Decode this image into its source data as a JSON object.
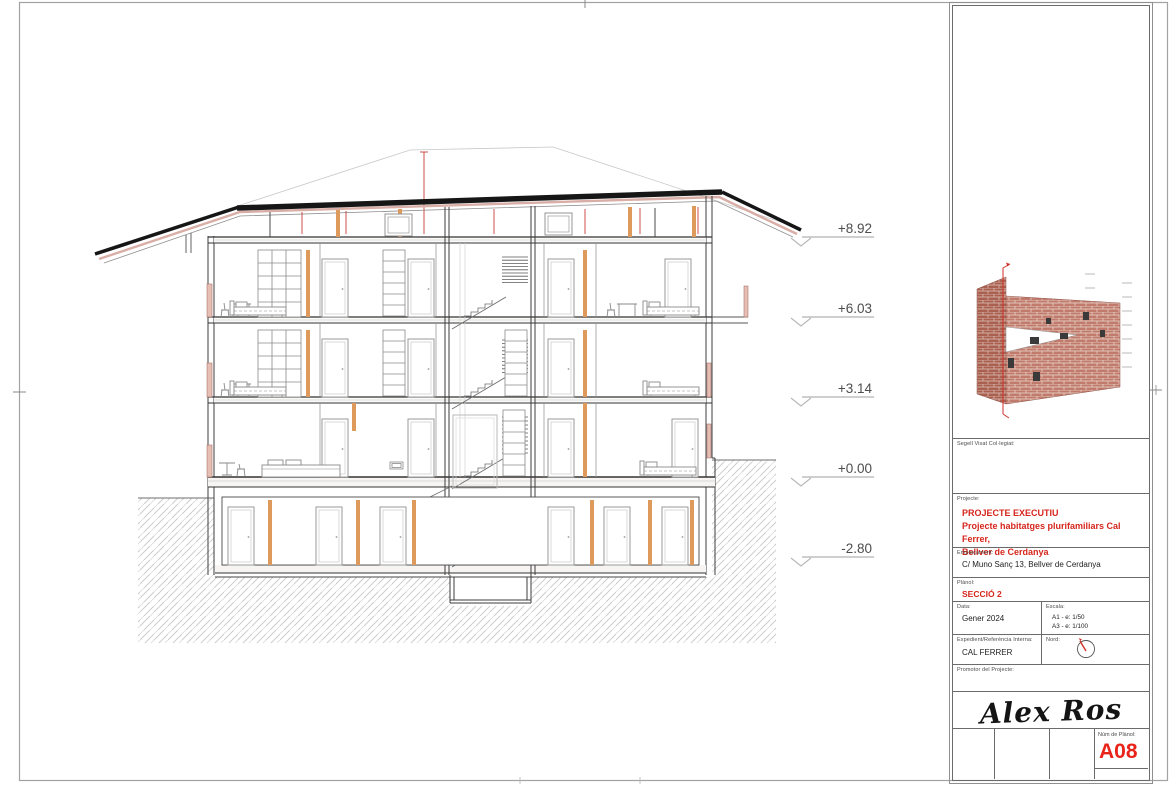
{
  "drawing": {
    "kind": "architectural-section-sheet",
    "elevations": [
      "+8.92",
      "+6.03",
      "+3.14",
      "+0.00",
      "-2.80"
    ]
  },
  "title_block": {
    "segell_label": "Segell Visat Col·legiat:",
    "projecte_label": "Projecte:",
    "projecte_line1": "PROJECTE EXECUTIU",
    "projecte_line2": "Projecte habitatges plurifamiliars Cal Ferrer,",
    "projecte_line3": "Bellver de Cerdanya",
    "emplacament_label": "Emplaçament:",
    "emplacament_value": "C/ Muno Sanç 13, Bellver de Cerdanya",
    "planol_label": "Plànol:",
    "planol_value": "SECCIÓ 2",
    "data_label": "Data:",
    "data_value": "Gener 2024",
    "escala_label": "Escala:",
    "escala_a1": "A1 - e: 1/50",
    "escala_a3": "A3 - e: 1/100",
    "expedient_label": "Expedient/Referència Interna:",
    "expedient_value": "CAL FERRER",
    "nord_label": "Nord:",
    "promotor_label": "Promotor del Projecte:",
    "signature": "Alex Ros",
    "num_planol_label": "Núm de Plànol:",
    "num_planol_value": "A08"
  },
  "colors": {
    "accent_red": "#d6261c",
    "sheet_red": "#e8231a",
    "timber_orange": "#de9a5a",
    "cut_pink": "#e6beb4",
    "brick": "#c17b6c"
  }
}
